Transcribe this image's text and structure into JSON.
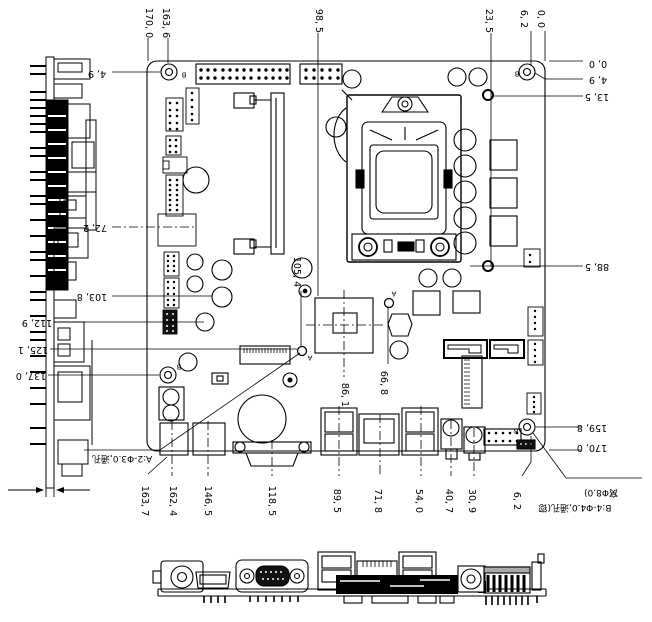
{
  "drawing": {
    "type": "motherboard mechanical dimension drawing",
    "views": [
      "side-view",
      "board-top-view",
      "board-bottom-view"
    ],
    "units_style": "comma decimal (mm)"
  },
  "dimension_labels": [
    {
      "t": "170, 0",
      "x": 148,
      "y": 23,
      "r": 90
    },
    {
      "t": "163, 6",
      "x": 165,
      "y": 23,
      "r": 90
    },
    {
      "t": "98, 5",
      "x": 318,
      "y": 21,
      "r": 90
    },
    {
      "t": "23, 5",
      "x": 488,
      "y": 21,
      "r": 90
    },
    {
      "t": "6, 2",
      "x": 523,
      "y": 19,
      "r": 90
    },
    {
      "t": "0, 0",
      "x": 540,
      "y": 19,
      "r": 90
    },
    {
      "t": "4, 9",
      "x": 97,
      "y": 73,
      "r": 180
    },
    {
      "t": "72, 2",
      "x": 95,
      "y": 227,
      "r": 180
    },
    {
      "t": "103, 8",
      "x": 92,
      "y": 296,
      "r": 180
    },
    {
      "t": "112, 9",
      "x": 37,
      "y": 322,
      "r": 180
    },
    {
      "t": "125, 1",
      "x": 33,
      "y": 349,
      "r": 180
    },
    {
      "t": "137, 0",
      "x": 31,
      "y": 375,
      "r": 180
    },
    {
      "t": "0, 0",
      "x": 598,
      "y": 63,
      "r": 180
    },
    {
      "t": "4, 9",
      "x": 598,
      "y": 79,
      "r": 180
    },
    {
      "t": "13, 5",
      "x": 597,
      "y": 96,
      "r": 180
    },
    {
      "t": "88, 5",
      "x": 597,
      "y": 266,
      "r": 180
    },
    {
      "t": "159, 8",
      "x": 592,
      "y": 427,
      "r": 180
    },
    {
      "t": "170, 0",
      "x": 592,
      "y": 447,
      "r": 180
    },
    {
      "t": "105, 4",
      "x": 296,
      "y": 272,
      "r": 90
    },
    {
      "t": "86, 1",
      "x": 344,
      "y": 395,
      "r": 90
    },
    {
      "t": "66, 8",
      "x": 383,
      "y": 383,
      "r": 90
    },
    {
      "t": "163, 7",
      "x": 144,
      "y": 501,
      "r": 90
    },
    {
      "t": "162, 4",
      "x": 172,
      "y": 501,
      "r": 90
    },
    {
      "t": "146, 5",
      "x": 207,
      "y": 501,
      "r": 90
    },
    {
      "t": "118, 5",
      "x": 271,
      "y": 501,
      "r": 90
    },
    {
      "t": "89, 5",
      "x": 336,
      "y": 501,
      "r": 90
    },
    {
      "t": "71, 8",
      "x": 377,
      "y": 501,
      "r": 90
    },
    {
      "t": "54, 0",
      "x": 418,
      "y": 501,
      "r": 90
    },
    {
      "t": "40, 7",
      "x": 448,
      "y": 501,
      "r": 90
    },
    {
      "t": "30, 9",
      "x": 471,
      "y": 501,
      "r": 90
    },
    {
      "t": "6, 2",
      "x": 516,
      "y": 501,
      "r": 90
    }
  ],
  "hole_markers": [
    {
      "t": "B",
      "x": 184,
      "y": 74
    },
    {
      "t": "B",
      "x": 517,
      "y": 73
    },
    {
      "t": "B",
      "x": 179,
      "y": 366
    },
    {
      "t": "B",
      "x": 516,
      "y": 430
    },
    {
      "t": "A",
      "x": 310,
      "y": 357
    },
    {
      "t": "A",
      "x": 394,
      "y": 293
    }
  ],
  "annotations": [
    {
      "t": "A:2-Φ3.0,通孔",
      "x": 122,
      "y": 458
    },
    {
      "t": "B:4-Φ4.0,通孔(锪",
      "x": 575,
      "y": 507
    },
    {
      "t": "窝Φ8.0)",
      "x": 601,
      "y": 492
    }
  ],
  "colors": {
    "line": "#000000",
    "background": "#ffffff",
    "fill_dark": "#111111"
  }
}
